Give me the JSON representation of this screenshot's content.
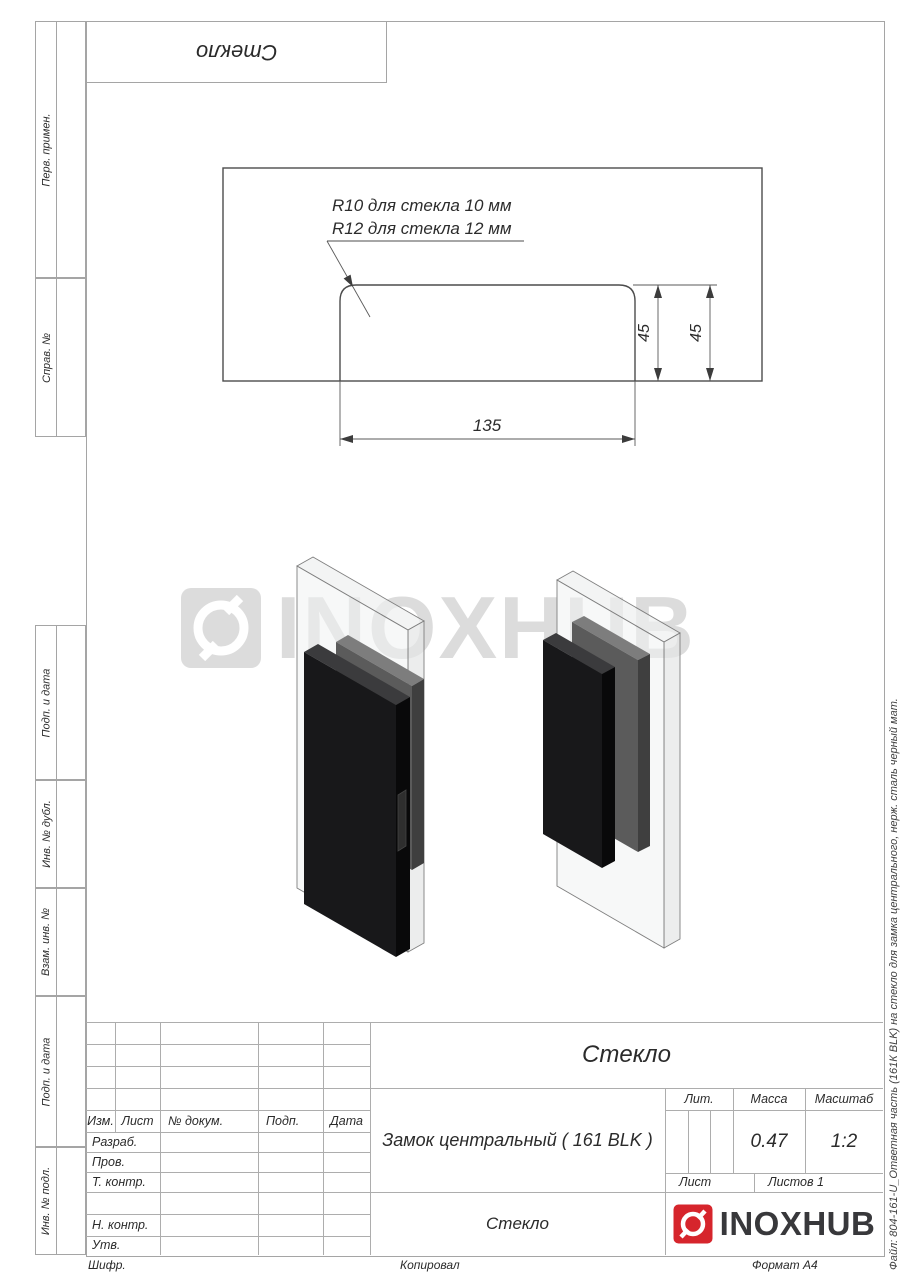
{
  "colors": {
    "accent_red": "#d6252c",
    "table_line": "#a5a5a5",
    "drawing_line": "#4c4c4c",
    "text": "#2b2b2b",
    "watermark": "#dcdcdc"
  },
  "top_block": {
    "title": "Стекло"
  },
  "sidebar": {
    "items": [
      {
        "label": "Перв. примен."
      },
      {
        "label": "Справ. №"
      },
      {
        "label": "Подп. и дата"
      },
      {
        "label": "Инв. № дубл."
      },
      {
        "label": "Взам. инв. №"
      },
      {
        "label": "Подп. и дата"
      },
      {
        "label": "Инв. № подл."
      }
    ]
  },
  "drawing": {
    "note_line1": "R10 для стекла 10 мм",
    "note_line2": "R12 для стекла 12 мм",
    "dim_width": "135",
    "dim_height_1": "45",
    "dim_height_2": "45"
  },
  "watermark": {
    "text": "INOXHUB"
  },
  "title_block": {
    "rev_headers": [
      "Изм.",
      "Лист",
      "№ докум.",
      "Подп.",
      "Дата"
    ],
    "sign_rows": [
      "Разраб.",
      "Пров.",
      "Т. контр.",
      "",
      "Н. контр.",
      "Утв."
    ],
    "doc_title": "Стекло",
    "doc_name": "Замок центральный ( 161 BLK )",
    "material": "Стекло",
    "lit_label": "Лит.",
    "mass_label": "Масса",
    "scale_label": "Масштаб",
    "mass_value": "0.47",
    "scale_value": "1:2",
    "sheet_label": "Лист",
    "sheets_label": "Листов 1",
    "logo_text": "INOXHUB"
  },
  "footer": {
    "cipher": "Шифр.",
    "copied": "Копировал",
    "format": "Формат А4"
  },
  "side_note": "Файл: 804-161-U_Ответная часть (161К BLK) на стекло для замка центрального, нерж. сталь черный мат."
}
